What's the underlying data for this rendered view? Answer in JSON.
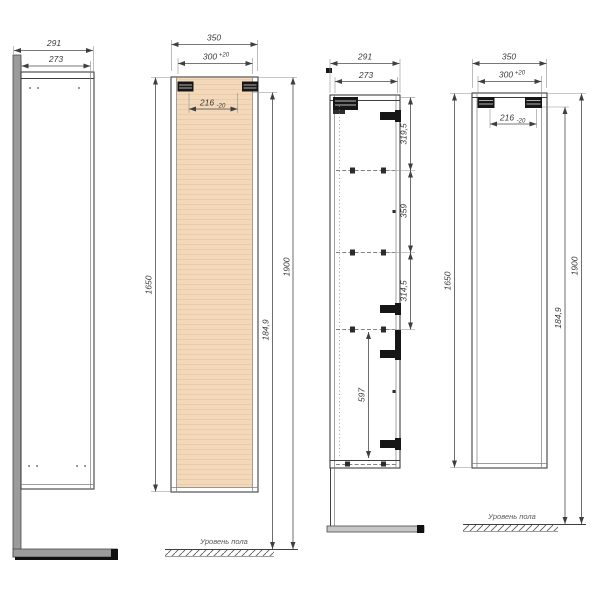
{
  "colors": {
    "panel_fill": "#f3d9ba",
    "panel_grain": "#ebccaa",
    "gray_panel": "#9b9b9b",
    "line": "#3f3f3f",
    "dim_text": "#3c3a36"
  },
  "floor_label": "Уровень пола",
  "dims": {
    "v1_total": "291",
    "v1_body": "273",
    "v2_total": "350",
    "v2_open": "300",
    "v2_open_tol": "+20",
    "v2_inner": "216",
    "v2_inner_tol": "-20",
    "v2_height": "1650",
    "v2_hook": "184,9",
    "v2_overall": "1900",
    "v3_total": "291",
    "v3_body": "273",
    "v3_seg1": "319,5",
    "v3_seg2": "359",
    "v3_seg3": "314,5",
    "v3_seg4": "597",
    "v4_total": "350",
    "v4_open": "300",
    "v4_open_tol": "+20",
    "v4_inner": "216",
    "v4_inner_tol": "-20",
    "v4_height": "1650",
    "v4_hook": "184,9",
    "v4_overall": "1900"
  }
}
